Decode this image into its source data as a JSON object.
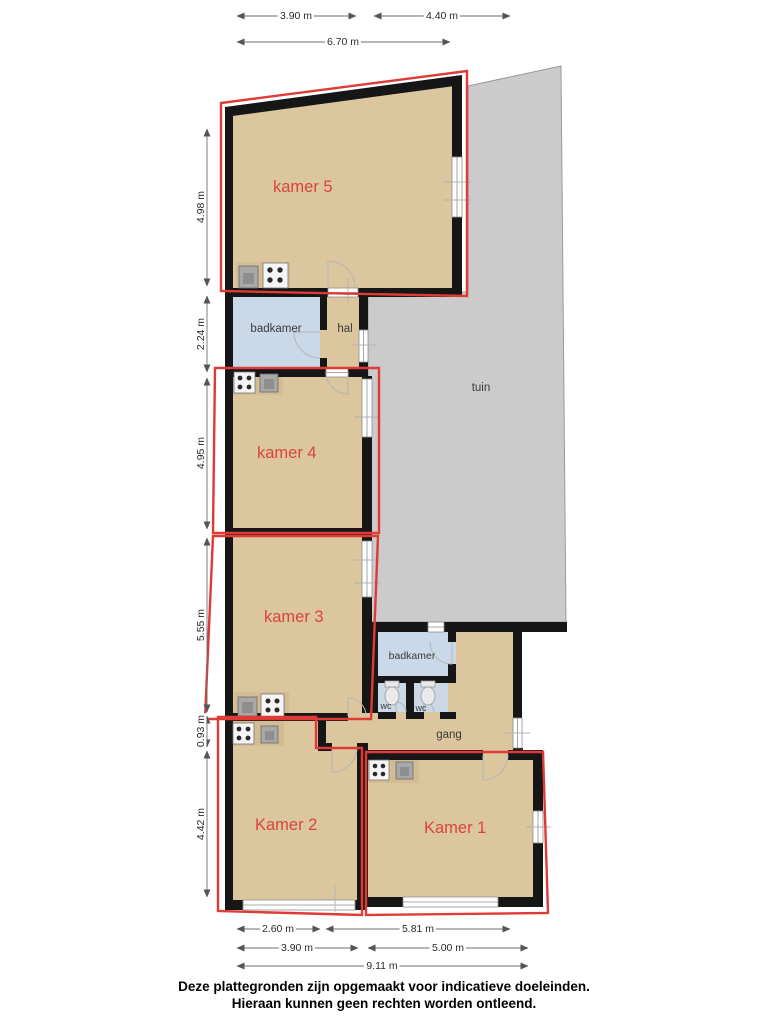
{
  "plan": {
    "rooms": {
      "kamer5": {
        "label": "kamer 5"
      },
      "kamer4": {
        "label": "kamer 4"
      },
      "kamer3": {
        "label": "kamer 3"
      },
      "kamer2": {
        "label": "Kamer 2"
      },
      "kamer1": {
        "label": "Kamer 1"
      },
      "badkamer_top": {
        "label": "badkamer"
      },
      "hal": {
        "label": "hal"
      },
      "tuin": {
        "label": "tuin"
      },
      "badkamer_mid": {
        "label": "badkamer"
      },
      "wc_left": {
        "label": "wc"
      },
      "wc_right": {
        "label": "wc"
      },
      "gang": {
        "label": "gang"
      }
    },
    "dimensions": {
      "top": [
        {
          "label": "3.90 m"
        },
        {
          "label": "4.40 m"
        },
        {
          "label": "6.70 m"
        }
      ],
      "left": [
        {
          "label": "4.98 m"
        },
        {
          "label": "2.24 m"
        },
        {
          "label": "4.95 m"
        },
        {
          "label": "5.55 m"
        },
        {
          "label": "0.93 m"
        },
        {
          "label": "4.42 m"
        }
      ],
      "bottom": [
        {
          "label": "2.60 m"
        },
        {
          "label": "5.81 m"
        },
        {
          "label": "3.90 m"
        },
        {
          "label": "5.00 m"
        },
        {
          "label": "9.11 m"
        }
      ]
    },
    "colors": {
      "floor": "#dbc69e",
      "wall": "#161616",
      "bathroom": "#c9d9e9",
      "garden": "#cbcbcb",
      "outline_red": "#e03a36",
      "room_label_red": "#d9453d"
    },
    "footer": {
      "line1": "Deze plattegronden zijn opgemaakt voor indicatieve doeleinden.",
      "line2": "Hieraan kunnen geen rechten worden ontleend."
    }
  }
}
